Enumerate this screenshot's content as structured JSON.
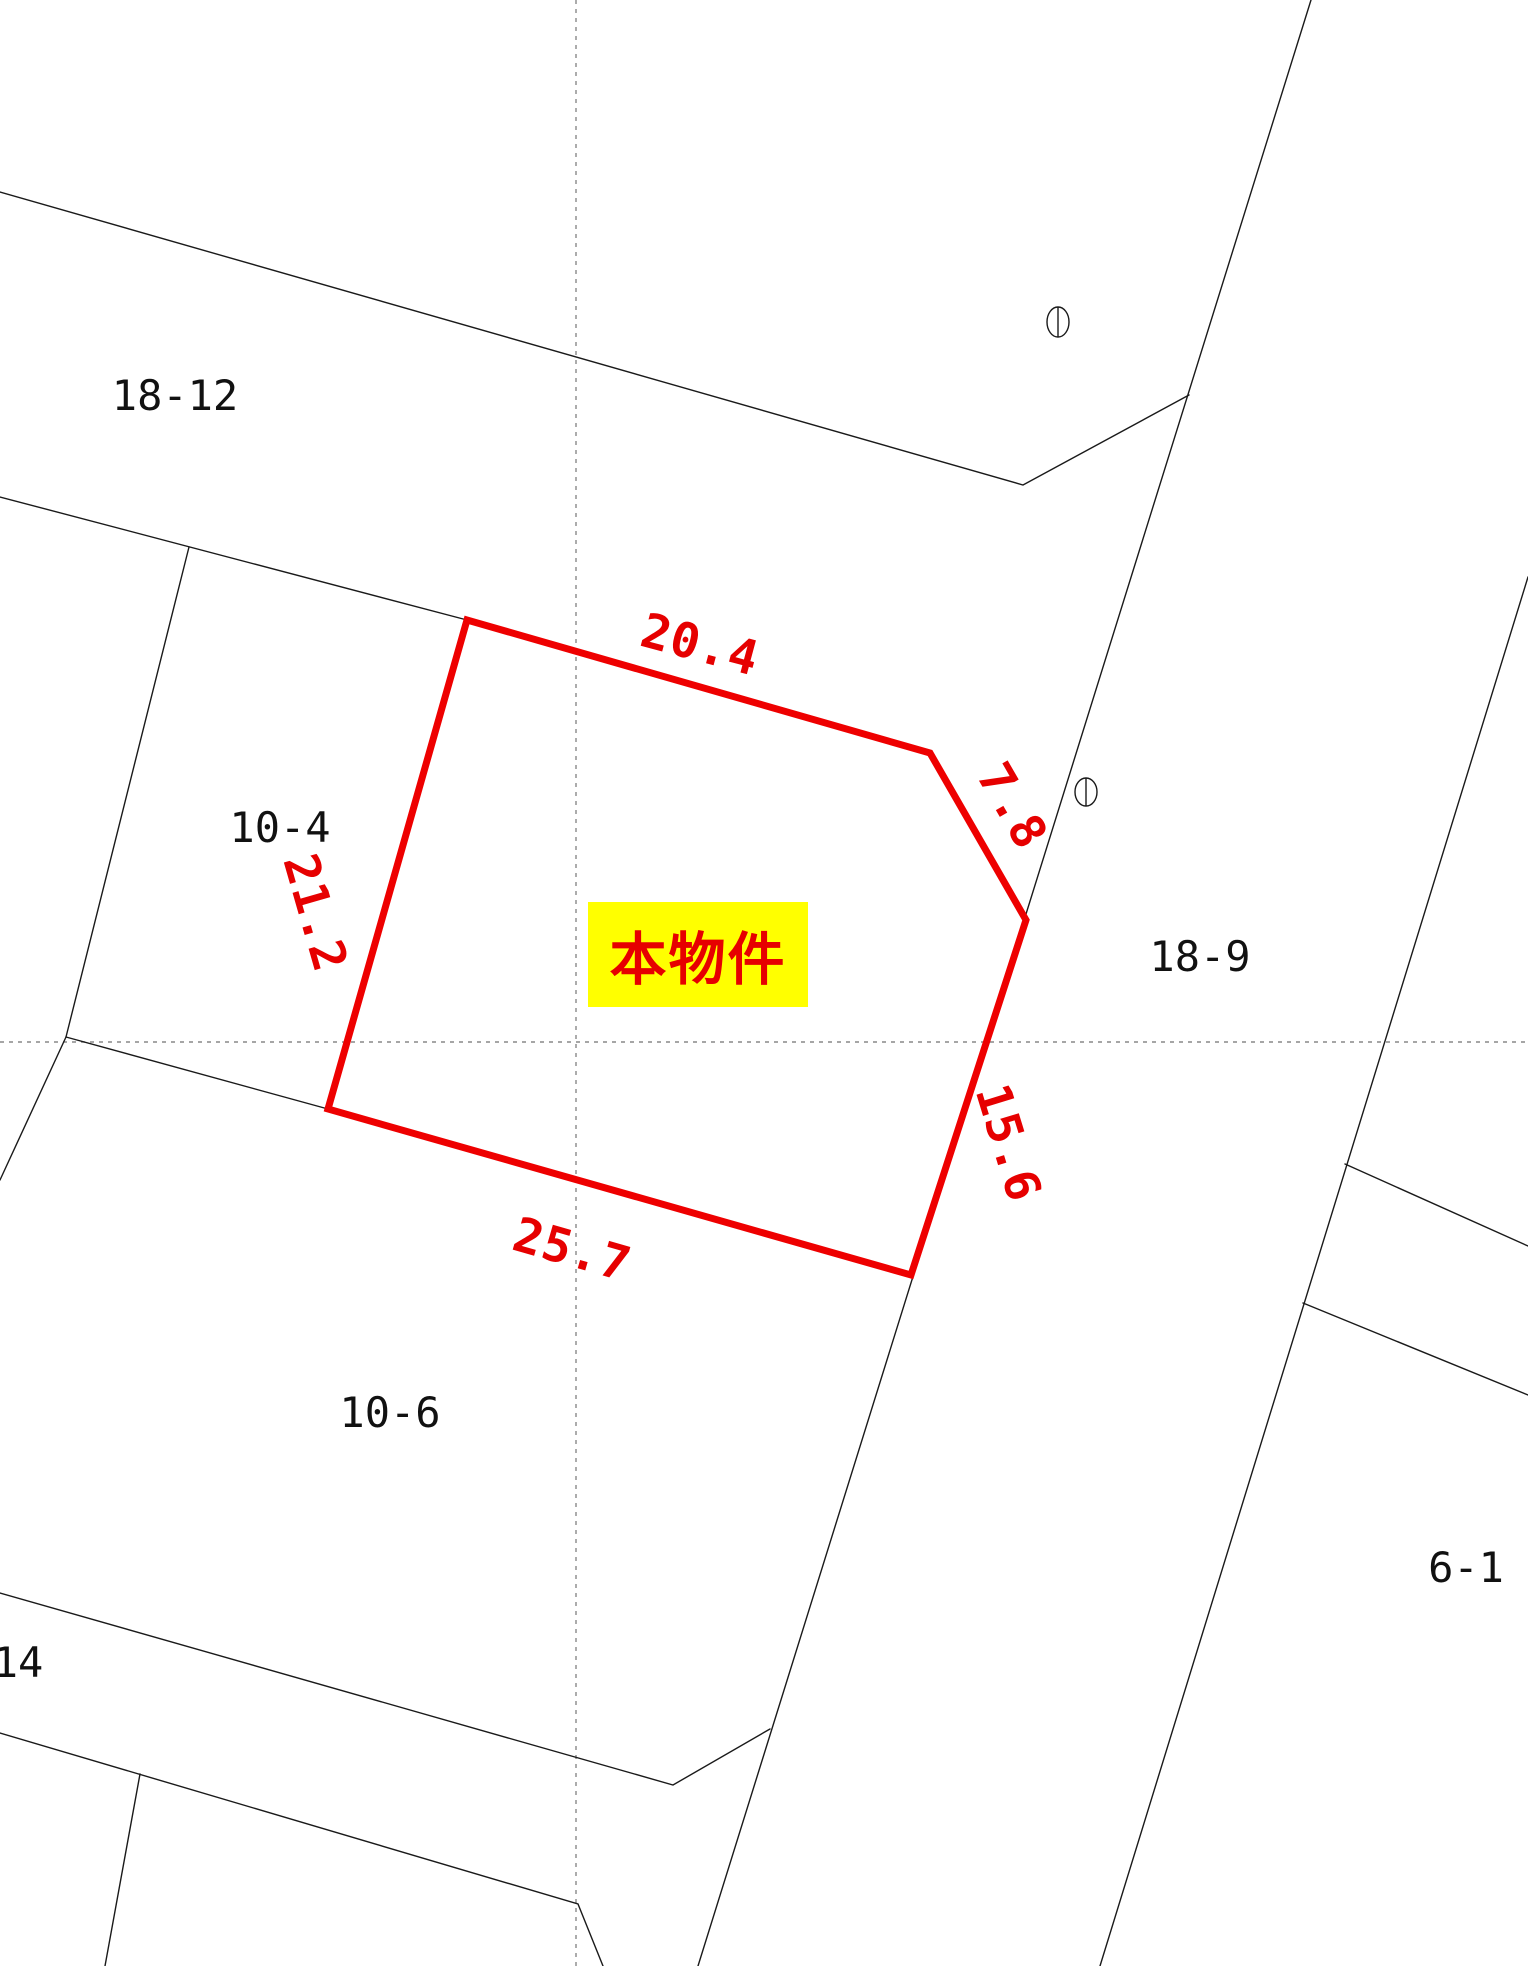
{
  "map_type": "cadastral-parcel-map",
  "colors": {
    "subject_outline_red": "#ee0000",
    "dimension_text_red": "#e60000",
    "highlight_yellow": "#ffff00",
    "boundary_line_black": "#1a1a1a",
    "grid_dotted_gray": "#888888"
  },
  "subject": {
    "label": "本物件",
    "outline": "red-polygon-5-sides"
  },
  "dimensions": {
    "top": "20.4",
    "corner_cut": "7.8",
    "left": "21.2",
    "right": "15.6",
    "bottom": "25.7"
  },
  "parcels": {
    "nw": "18-12",
    "west": "10-4",
    "east": "18-9",
    "south": "10-6",
    "southeast": "6-1",
    "southwest": "14"
  },
  "symbols": {
    "survey_marker": "ellipse-with-vertical-line",
    "survey_marker_count": 2
  },
  "grid": {
    "vertical_dotted_line": 1,
    "horizontal_dotted_line": 1
  }
}
